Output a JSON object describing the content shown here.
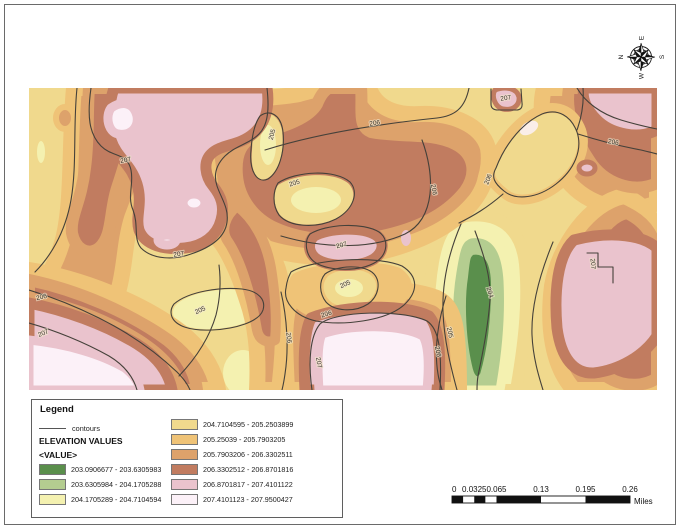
{
  "page": {
    "background": "#ffffff",
    "border_color": "#6a6a6a"
  },
  "legend": {
    "title": "Legend",
    "contour_symbol_label": "contours",
    "section_title": "ELEVATION VALUES",
    "value_field": "<VALUE>",
    "classes": [
      {
        "color": "#5a8f4c",
        "label": "203.0906677 - 203.6305983"
      },
      {
        "color": "#b4cd90",
        "label": "203.6305984 - 204.1705288"
      },
      {
        "color": "#f4f1b0",
        "label": "204.1705289 - 204.7104594"
      },
      {
        "color": "#f0d98d",
        "label": "204.7104595 - 205.2503899"
      },
      {
        "color": "#efc377",
        "label": "205.25039 - 205.7903205"
      },
      {
        "color": "#dda26b",
        "label": "205.7903206 - 206.3302511"
      },
      {
        "color": "#c17c60",
        "label": "206.3302512 - 206.8701816"
      },
      {
        "color": "#eac3cd",
        "label": "206.8701817 - 207.4101122"
      },
      {
        "color": "#fcf1f8",
        "label": "207.4101123 - 207.9500427"
      }
    ]
  },
  "map": {
    "contour_color": "#45413a",
    "contour_labels": [
      {
        "text": "207",
        "x": 97,
        "y": 74,
        "rot": -10
      },
      {
        "text": "205",
        "x": 245,
        "y": 47,
        "rot": -75
      },
      {
        "text": "206",
        "x": 346,
        "y": 37,
        "rot": -8
      },
      {
        "text": "207",
        "x": 477,
        "y": 12,
        "rot": -8
      },
      {
        "text": "206",
        "x": 584,
        "y": 56,
        "rot": 11
      },
      {
        "text": "206",
        "x": 461,
        "y": 92,
        "rot": -68
      },
      {
        "text": "205",
        "x": 266,
        "y": 97,
        "rot": -18
      },
      {
        "text": "206",
        "x": 403,
        "y": 102,
        "rot": 80
      },
      {
        "text": "207",
        "x": 150,
        "y": 168,
        "rot": -8
      },
      {
        "text": "207",
        "x": 313,
        "y": 159,
        "rot": -15
      },
      {
        "text": "205",
        "x": 317,
        "y": 198,
        "rot": -25
      },
      {
        "text": "206",
        "x": 298,
        "y": 228,
        "rot": -18
      },
      {
        "text": "206",
        "x": 13,
        "y": 211,
        "rot": -14
      },
      {
        "text": "207",
        "x": 15,
        "y": 247,
        "rot": -22
      },
      {
        "text": "205",
        "x": 172,
        "y": 224,
        "rot": -25
      },
      {
        "text": "206",
        "x": 258,
        "y": 250,
        "rot": 84
      },
      {
        "text": "207",
        "x": 288,
        "y": 275,
        "rot": 80
      },
      {
        "text": "206",
        "x": 407,
        "y": 264,
        "rot": 78
      },
      {
        "text": "204",
        "x": 459,
        "y": 205,
        "rot": 72
      },
      {
        "text": "205",
        "x": 419,
        "y": 245,
        "rot": 76
      },
      {
        "text": "207",
        "x": 562,
        "y": 176,
        "rot": 85
      }
    ]
  },
  "scale_bar": {
    "tick_labels": [
      "0",
      "0.0325",
      "0.065",
      "0.13",
      "0.195",
      "0.26"
    ],
    "unit_label": "Miles"
  },
  "compass": {
    "letters": [
      "N",
      "E",
      "S",
      "W"
    ]
  }
}
